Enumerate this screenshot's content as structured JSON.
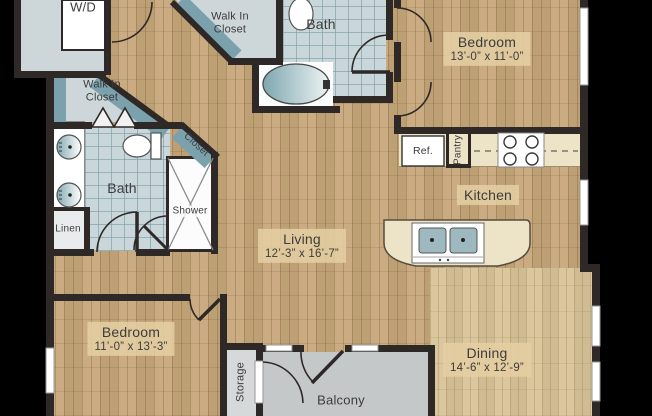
{
  "plan": {
    "rooms": {
      "laundry": {
        "label": "W/D"
      },
      "walk_in_closet_top": {
        "line1": "Walk In",
        "line2": "Closet"
      },
      "walk_in_closet_left": {
        "line1": "Walk In",
        "line2": "Closet"
      },
      "bath_top": {
        "label": "Bath"
      },
      "bath_left": {
        "label": "Bath"
      },
      "bedroom_top": {
        "label": "Bedroom",
        "dims": "13’-0” x 11’-0”"
      },
      "bedroom_bottom": {
        "label": "Bedroom",
        "dims": "11’-0” x 13’-3”"
      },
      "kitchen": {
        "label": "Kitchen"
      },
      "living": {
        "label": "Living",
        "dims": "12’-3” x 16’-7”"
      },
      "dining": {
        "label": "Dining",
        "dims": "14’-6” x 12’-9”"
      },
      "closet_hall": {
        "label": "Closet"
      },
      "shower": {
        "label": "Shower"
      },
      "linen": {
        "label": "Linen"
      },
      "pantry": {
        "label": "Pantry"
      },
      "refrigerator": {
        "label": "Ref."
      },
      "storage": {
        "label": "Storage"
      },
      "balcony": {
        "label": "Balcony"
      }
    },
    "colors": {
      "wall": "#2e2927",
      "wood": "#c8a87b",
      "wood_light": "#d8c498",
      "tile": "#c9d6da",
      "teal": "#7aa1ac",
      "room": "#cdd7da",
      "counter": "#ede4c8",
      "balcony": "#c5c8c9"
    }
  }
}
